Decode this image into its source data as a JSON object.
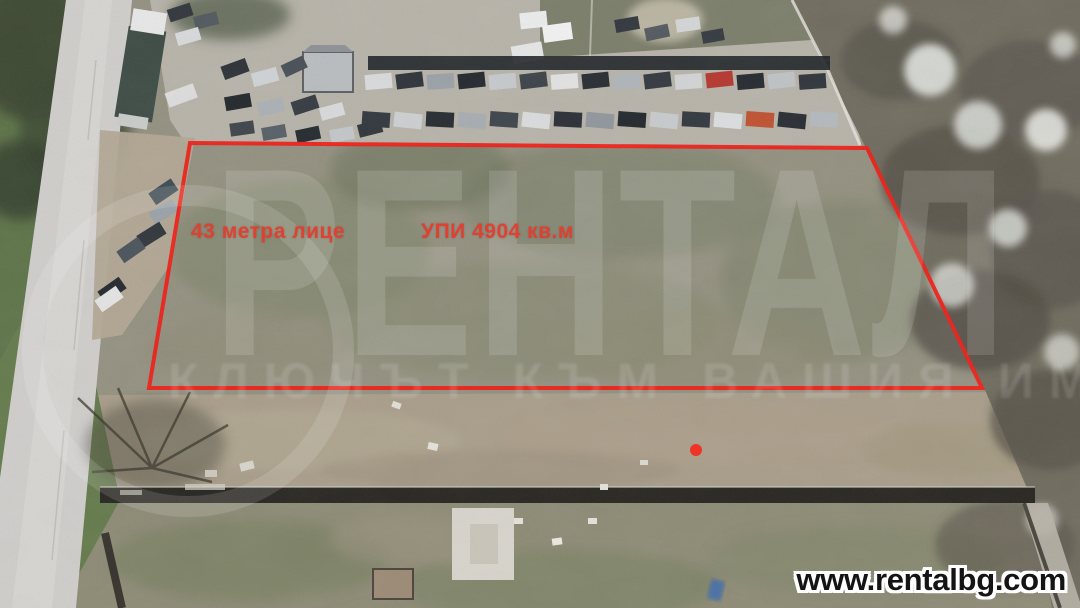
{
  "page": {
    "width": 1080,
    "height": 608,
    "kind": "aerial-property-listing-photo"
  },
  "annotations": {
    "frontage_label": "43 метра лице",
    "area_label": "УПИ 4904 кв.м",
    "label_color": "#e23c2d"
  },
  "watermark": {
    "brand": "РЕНТАЛ",
    "slogan": "КЛЮЧЪТ КЪМ ВАШИЯ ИМОТ",
    "color": "#ffffff"
  },
  "footer": {
    "website": "www.rentalbg.com",
    "text_color": "#141414",
    "outline_color": "#ffffff"
  },
  "scene": {
    "boundary_color": "#ee1d16",
    "marker_color": "#f32b1d",
    "road_color": "#cfcecb",
    "grass_color": "#5d7347",
    "field_color": "#93907f",
    "parking_color": "#b7b3a9",
    "shrub_color": "#6f6b5d",
    "dirt_color": "#a89d89",
    "wall_color": "#26241f"
  }
}
